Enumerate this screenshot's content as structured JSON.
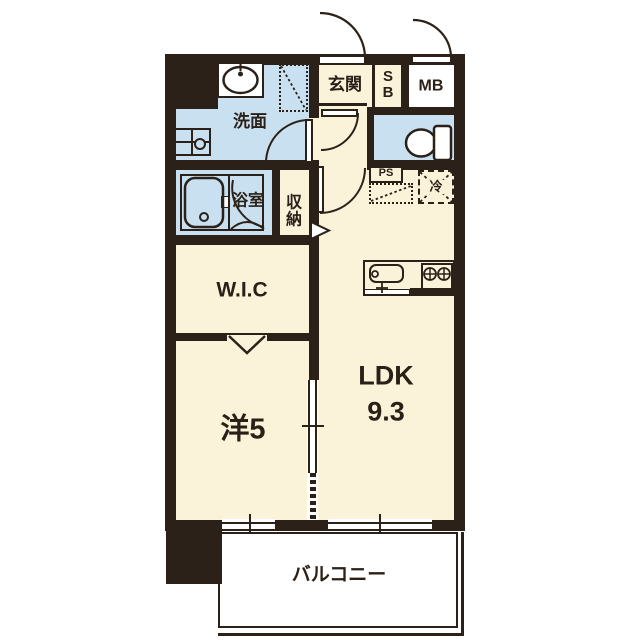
{
  "title": "apartment-floor-plan",
  "labels": {
    "entrance": "玄関",
    "shoebox_s": "S",
    "shoebox_b": "B",
    "meter_box": "MB",
    "washroom": "洗面",
    "bathroom": "浴室",
    "storage_top": "収",
    "storage_bottom": "納",
    "toilet_pipe_space": "PS",
    "refrigerator": "冷",
    "walk_in_closet": "W.I.C",
    "western_room": "洋5",
    "ldk": "LDK",
    "ldk_size": "9.3",
    "balcony": "バルコニー"
  },
  "colors": {
    "wall": "#2b2118",
    "floor_cream": "#faf3da",
    "wet_area_blue": "#c8e0f0",
    "background": "#ffffff"
  }
}
